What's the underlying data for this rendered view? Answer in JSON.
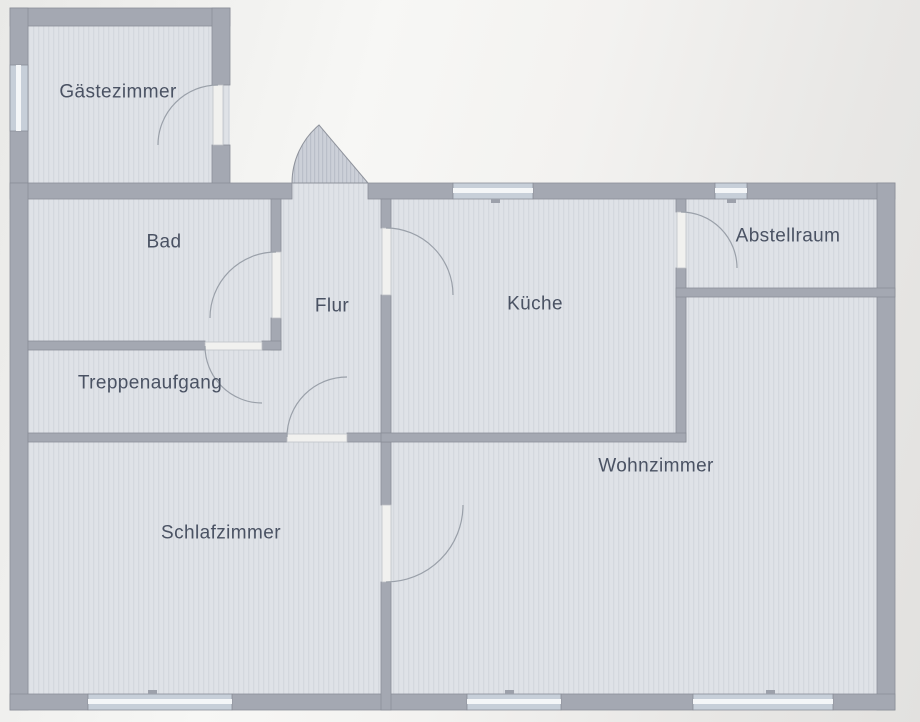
{
  "floorplan": {
    "rooms": [
      {
        "id": "gaestezimmer",
        "label": "Gästezimmer"
      },
      {
        "id": "bad",
        "label": "Bad"
      },
      {
        "id": "flur",
        "label": "Flur"
      },
      {
        "id": "kueche",
        "label": "Küche"
      },
      {
        "id": "abstellraum",
        "label": "Abstellraum"
      },
      {
        "id": "treppenaufgang",
        "label": "Treppenaufgang"
      },
      {
        "id": "wohnzimmer",
        "label": "Wohnzimmer"
      },
      {
        "id": "schlafzimmer",
        "label": "Schlafzimmer"
      }
    ],
    "colors": {
      "background": "#f3f2f0",
      "floor": "#dfe2e7",
      "wall": "#a4a8b2",
      "wall_edge": "#8a8e98",
      "door_leaf": "#f1f1ef",
      "window_glass": "#c7cfd9",
      "label_text": "#4a5263"
    }
  }
}
